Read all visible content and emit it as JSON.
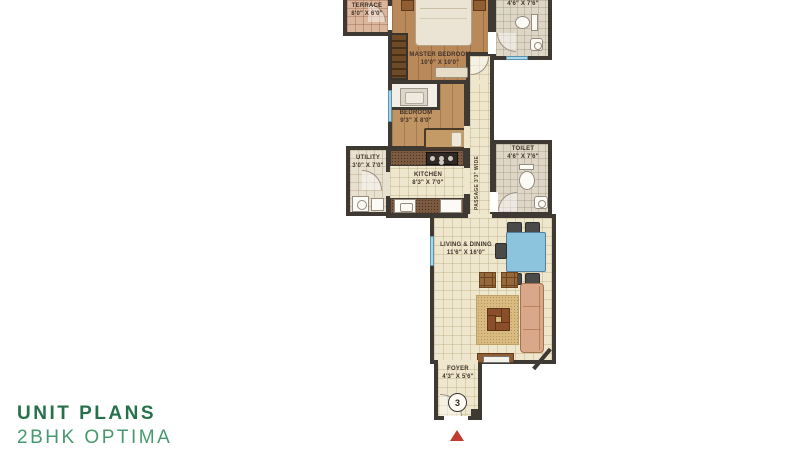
{
  "title_block": {
    "title": "UNIT PLANS",
    "subtitle": "2BHK OPTIMA"
  },
  "floorplan": {
    "terrace": {
      "name": "TERRACE",
      "dims": "8'0\" X 6'0\""
    },
    "master_bedroom": {
      "name": "MASTER BEDROOM",
      "dims": "10'0\" X 10'0\""
    },
    "toilet_attached": {
      "dims": "4'6\" X 7'6\""
    },
    "bedroom": {
      "name": "BEDROOM",
      "dims": "9'3\" X 8'0\""
    },
    "utility": {
      "name": "UTILITY",
      "dims": "3'0\" X 7'0\""
    },
    "kitchen": {
      "name": "KITCHEN",
      "dims": "8'3\" X 7'0\""
    },
    "passage": {
      "label": "PASSAGE 3'3\" WIDE"
    },
    "toilet": {
      "name": "TOILET",
      "dims": "4'6\" X 7'6\""
    },
    "living_dining": {
      "name": "LIVING & DINING",
      "dims": "11'6\" X 16'0\""
    },
    "foyer": {
      "name": "FOYER",
      "dims": "4'3\" X 5'6\""
    },
    "unit_number": "3"
  },
  "colors": {
    "title_green_dark": "#26704C",
    "title_green": "#46996F",
    "wall": "#3E3933",
    "window_blue": "#A9D6EA",
    "entrance_marker_red": "#C23B2F",
    "dining_table_blue": "#8BC4DC"
  }
}
